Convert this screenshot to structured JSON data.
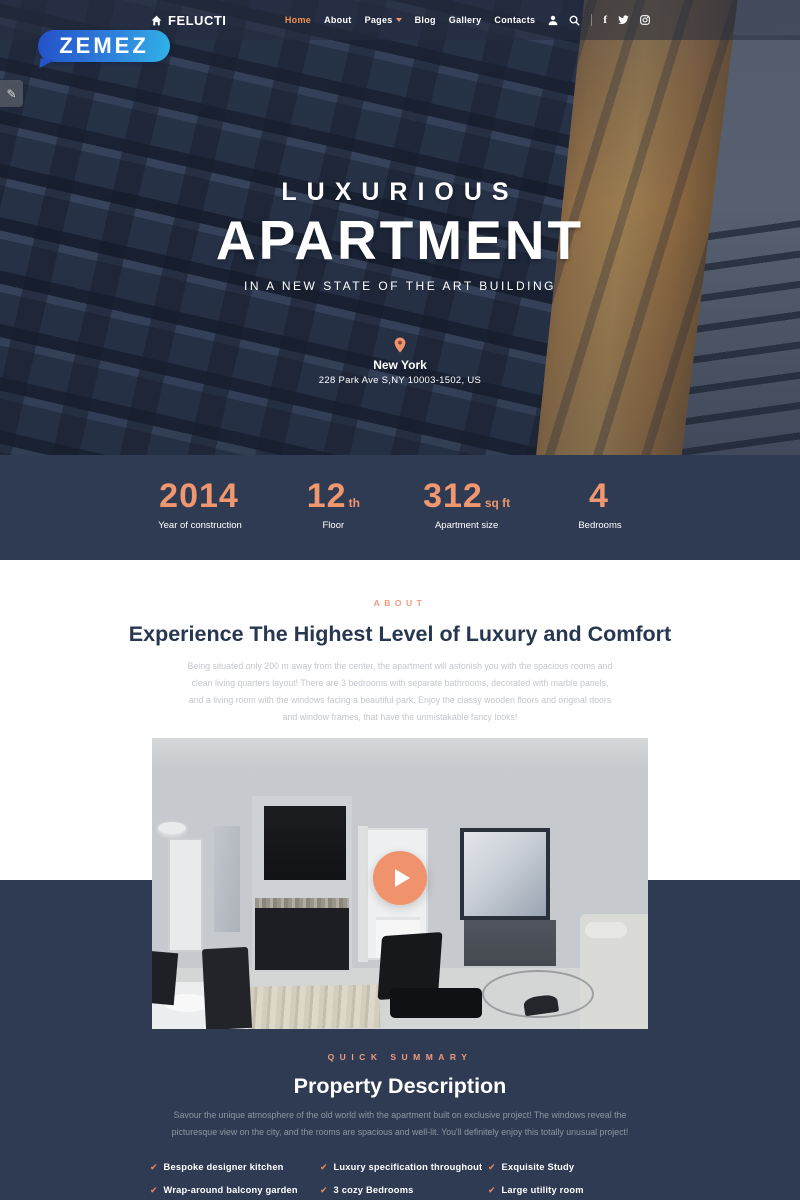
{
  "brand_badge": {
    "text": "ZEMEZ"
  },
  "navbar": {
    "logo": "FELUCTI",
    "menu": [
      {
        "label": "Home"
      },
      {
        "label": "About"
      },
      {
        "label": "Pages"
      },
      {
        "label": "Blog"
      },
      {
        "label": "Gallery"
      },
      {
        "label": "Contacts"
      }
    ]
  },
  "hero": {
    "eyebrow": "LUXURIOUS",
    "title": "APARTMENT",
    "subtitle": "IN A NEW STATE OF THE ART BUILDING",
    "location_city": "New York",
    "location_address": "228 Park Ave S,NY 10003-1502, US"
  },
  "stats": [
    {
      "value": "2014",
      "unit": "",
      "label": "Year of construction"
    },
    {
      "value": "12",
      "unit": "th",
      "label": "Floor"
    },
    {
      "value": "312",
      "unit": "sq ft",
      "label": "Apartment size"
    },
    {
      "value": "4",
      "unit": "",
      "label": "Bedrooms"
    }
  ],
  "about": {
    "eyebrow": "ABOUT",
    "heading": "Experience The Highest Level of Luxury and Comfort",
    "paragraph": "Being situated only 200 m away from the center, the apartment will astonish you with the spacious rooms and clean living quarters layout! There are 3 bedrooms with separate bathrooms, decorated with marble panels, and a living room with the windows facing a beautiful park. Enjoy the classy wooden floors and original doors and window frames, that have the unmistakable fancy looks!"
  },
  "summary": {
    "eyebrow": "QUICK SUMMARY",
    "heading": "Property Description",
    "paragraph": "Savour the unique atmosphere of the old world with the apartment built on exclusive project! The windows reveal the picturesque view on the city, and the rooms are spacious and well-lit. You'll definitely enjoy this totally unusual project!",
    "features": [
      "Bespoke designer kitchen",
      "Luxury specification throughout",
      "Exquisite Study",
      "Wrap-around balcony garden",
      "3 cozy Bedrooms",
      "Large utility room",
      "Close to the city cente",
      "Separate bathrooms",
      "French windows"
    ]
  },
  "colors": {
    "accent": "#f0936c",
    "navy": "#2f3b52",
    "badge_gradient_start": "#2450c8",
    "badge_gradient_end": "#31b3e8"
  }
}
